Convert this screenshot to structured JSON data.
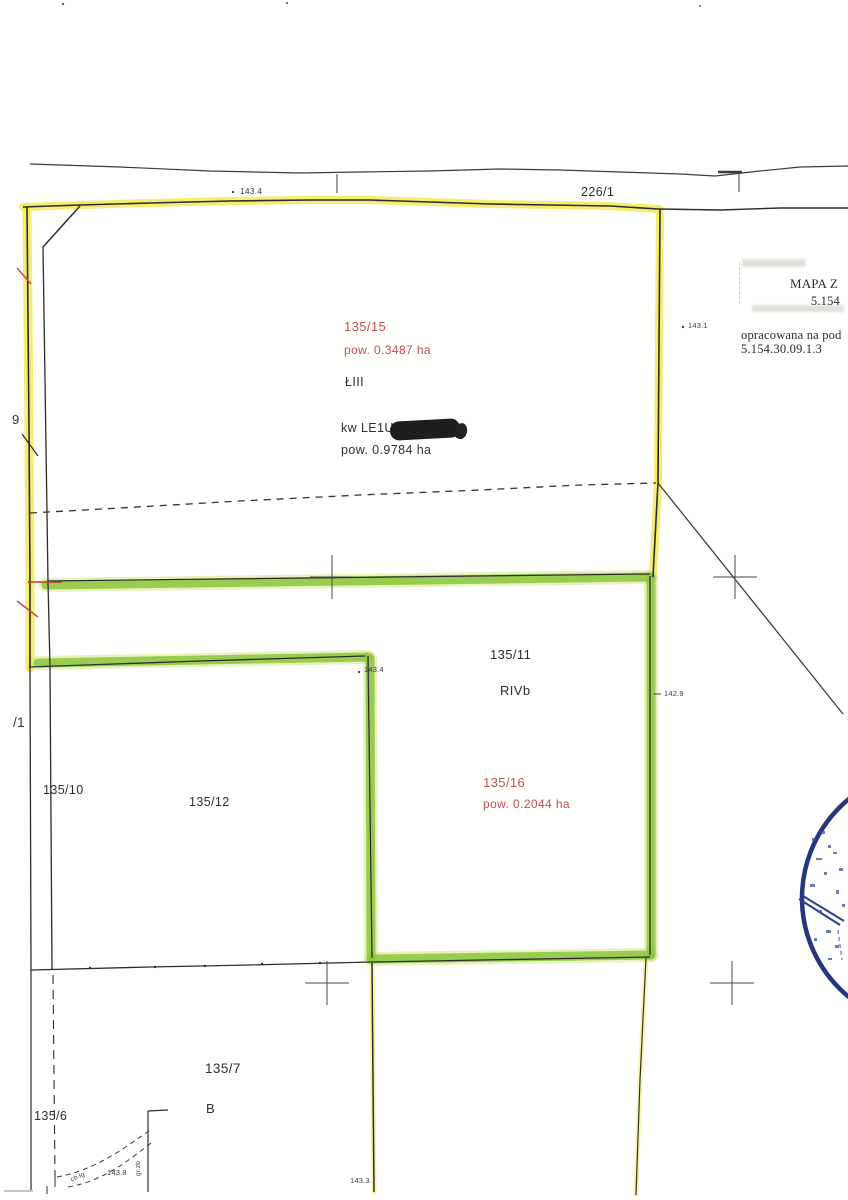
{
  "labels": {
    "road": {
      "parcel": "226/1",
      "elevation": "143.4"
    },
    "parcel_135_15": {
      "id": "135/15",
      "area": "pow. 0.3487 ha",
      "land_class": "ŁIII",
      "register": "kw LE1U",
      "total_area": "pow. 0.9784 ha",
      "elevation": "143.1"
    },
    "parcel_135_11": {
      "id": "135/11",
      "land_class": "RIVb",
      "elevation": "142.9",
      "corner_elevation": "143.4"
    },
    "parcel_135_16": {
      "id": "135/16",
      "area": "pow. 0.2044 ha"
    },
    "parcel_135_10": {
      "id": "135/10"
    },
    "parcel_135_12": {
      "id": "135/12"
    },
    "parcel_135_7": {
      "id": "135/7",
      "building": "B",
      "elevation": "143.8",
      "edge_elevation": "143.3",
      "ditch": "cb.łg",
      "boundary": "gr.zb"
    },
    "parcel_135_6": {
      "id": "135/6"
    },
    "edge_fragments": {
      "top": "9",
      "bottom": "/1"
    }
  },
  "title_block": {
    "line1": "MAPA Z",
    "line2": "5.154",
    "line3": "opracowana na pod",
    "line4": "5.154.30.09.1.3"
  },
  "colors": {
    "highlight_yellow": "#f2e84e",
    "highlight_green": "#8cc63e",
    "annotation_red": "#c0504d",
    "stamp_blue": "#2b3f90",
    "linework": "#333333"
  }
}
